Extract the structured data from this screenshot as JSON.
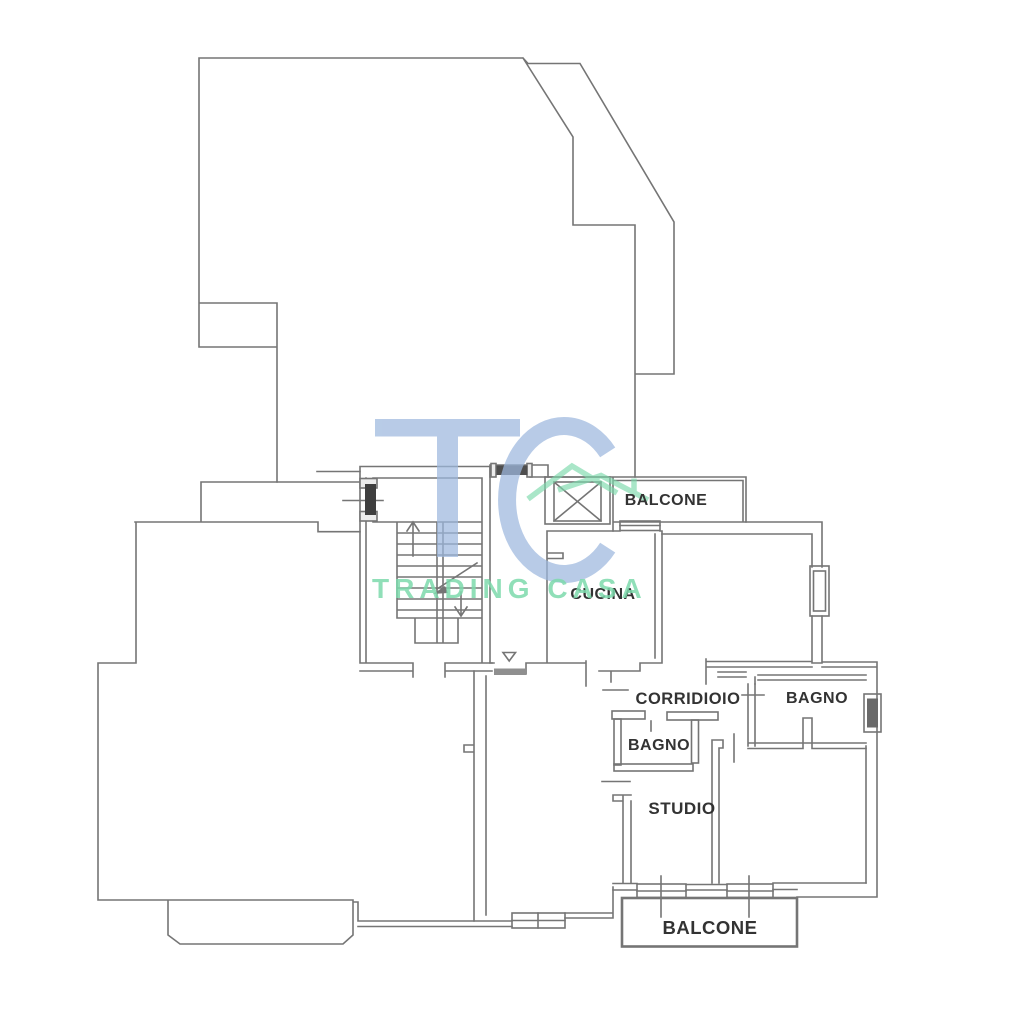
{
  "page": {
    "background": "#ffffff"
  },
  "watermark": {
    "logo_text": "TC",
    "brand_text": "TRADING CASA",
    "blue_color": "#9db8de",
    "green_color": "#7cd9ab"
  },
  "floorplan": {
    "line_color": "#757575",
    "label_color": "#333333",
    "labels": {
      "balcone_top": "BALCONE",
      "cucina": "CUCINA",
      "corridoio": "CORRIDIOIO",
      "bagno_right": "BAGNO",
      "bagno_small": "BAGNO",
      "studio": "STUDIO",
      "balcone_bottom": "BALCONE"
    }
  }
}
